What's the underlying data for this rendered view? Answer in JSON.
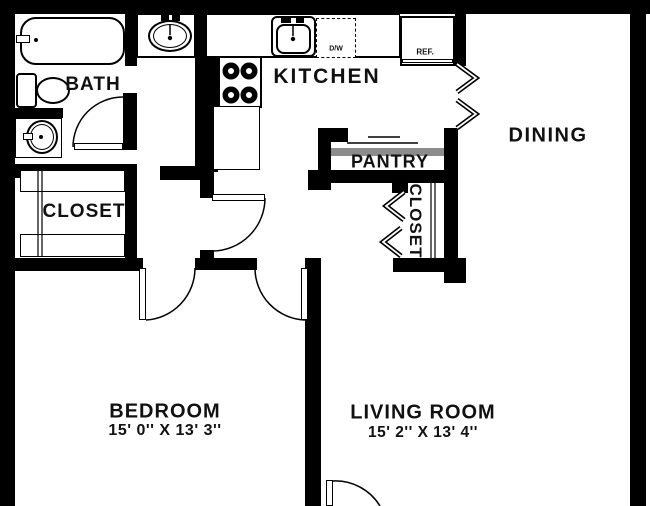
{
  "plan_title": "One-bedroom apartment floor plan",
  "rooms": {
    "bath": {
      "label": "BATH"
    },
    "kitchen": {
      "label": "KITCHEN"
    },
    "dining": {
      "label": "DINING"
    },
    "pantry": {
      "label": "PANTRY"
    },
    "closet_hall": {
      "label": "CLOSET"
    },
    "closet_entry": {
      "label": "CLOSET"
    },
    "bedroom": {
      "label": "BEDROOM",
      "dimensions": "15' 0'' X 13' 3''"
    },
    "living_room": {
      "label": "LIVING ROOM",
      "dimensions": "15' 2'' X 13' 4''"
    }
  },
  "appliances": {
    "dishwasher": "D/W",
    "refrigerator": "REF."
  },
  "colors": {
    "wall": "#000000",
    "floor": "#ffffff",
    "shelf_gray": "#8c8c8c"
  }
}
